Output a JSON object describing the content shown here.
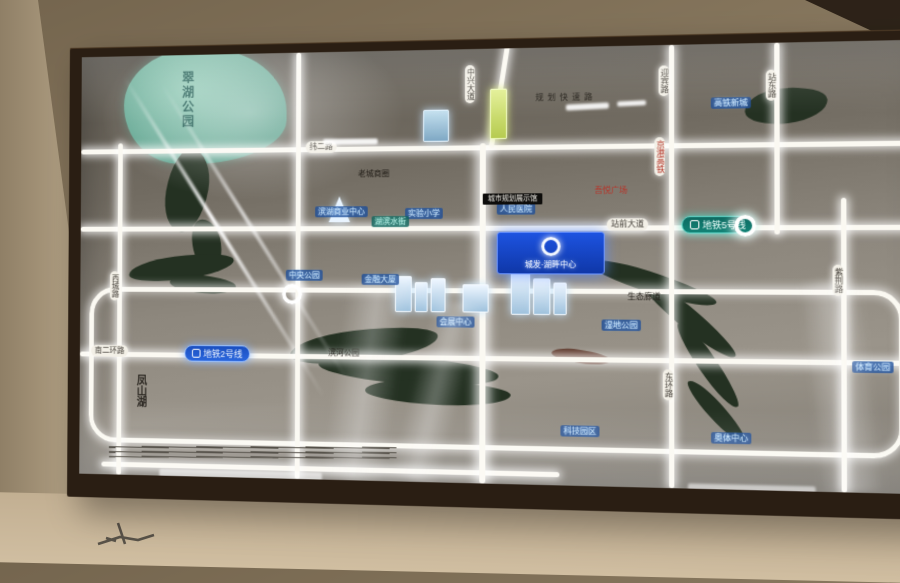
{
  "map": {
    "project_badge": {
      "name": "城发·湖畔中心",
      "logo": "ring-logo"
    },
    "metro_lines": [
      {
        "label": "地铁5号线",
        "color": "#0f7b72"
      },
      {
        "label": "地铁2号线",
        "color": "#1e56c8"
      }
    ],
    "area_labels": {
      "lake": "翠湖公园",
      "bottom_left": "凤山湖",
      "right_edge": "凤凰山",
      "right_edge_badge": "东站"
    },
    "road_labels_vertical": [
      "中兴大道",
      "迎宾路",
      "京港高铁",
      "站东路",
      "紫荆路",
      "东环路",
      "西城路"
    ],
    "road_labels_horizontal": [
      "纬二路",
      "站前大道",
      "南二环路"
    ],
    "poi_labels_blue": [
      "滨湖商业中心",
      "实验小学",
      "人民医院",
      "中央公园",
      "金融大厦",
      "会展中心",
      "高铁新城",
      "湿地公园",
      "科技园区",
      "奥体中心",
      "体育公园"
    ],
    "poi_label_teal": "湖滨水街",
    "poi_labels_black": [
      "老城商圈",
      "滨河公园",
      "生态廊道",
      "规划快速路"
    ],
    "poi_label_red": "吾悦广场",
    "poi_label_dark_bar": "城市规划展示馆"
  },
  "colors": {
    "frame": "#2a1e13",
    "wall": "#93836a",
    "map_background": "#8d877d",
    "road_glow": "#fbf9f2",
    "water_teal": "#6fb4a0",
    "water_dark": "#243122",
    "metro_line5_teal": "#0f7b72",
    "metro_line2_blue": "#1e56c8",
    "badge_blue": "#1747c9",
    "accent_red": "#b5342a",
    "building_yellow": "#cfe070"
  }
}
